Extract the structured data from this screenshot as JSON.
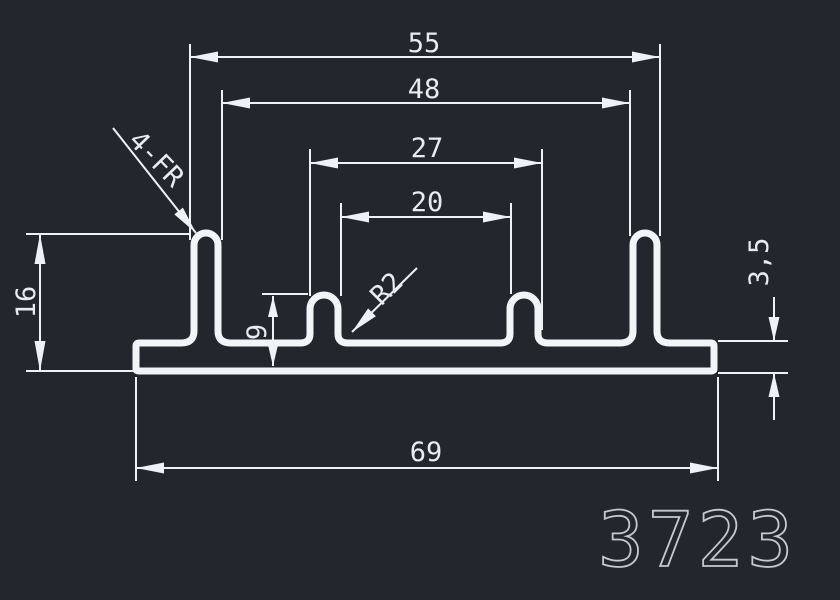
{
  "drawing": {
    "part_number": "3723",
    "background_color": "#23262c",
    "line_color": "#f2f4f7",
    "text_color": "#e8ebef",
    "part_number_color": "#c4c9d1",
    "dim_labels": {
      "fins_outer_width": "55",
      "fins_inner_width": "48",
      "ribs_outer_width": "27",
      "ribs_inner_width": "20",
      "overall_width": "69",
      "overall_height": "16",
      "rib_height": "9",
      "base_thickness": "3,5",
      "radius_note": "R2",
      "fillet_note": "4-FR"
    }
  }
}
